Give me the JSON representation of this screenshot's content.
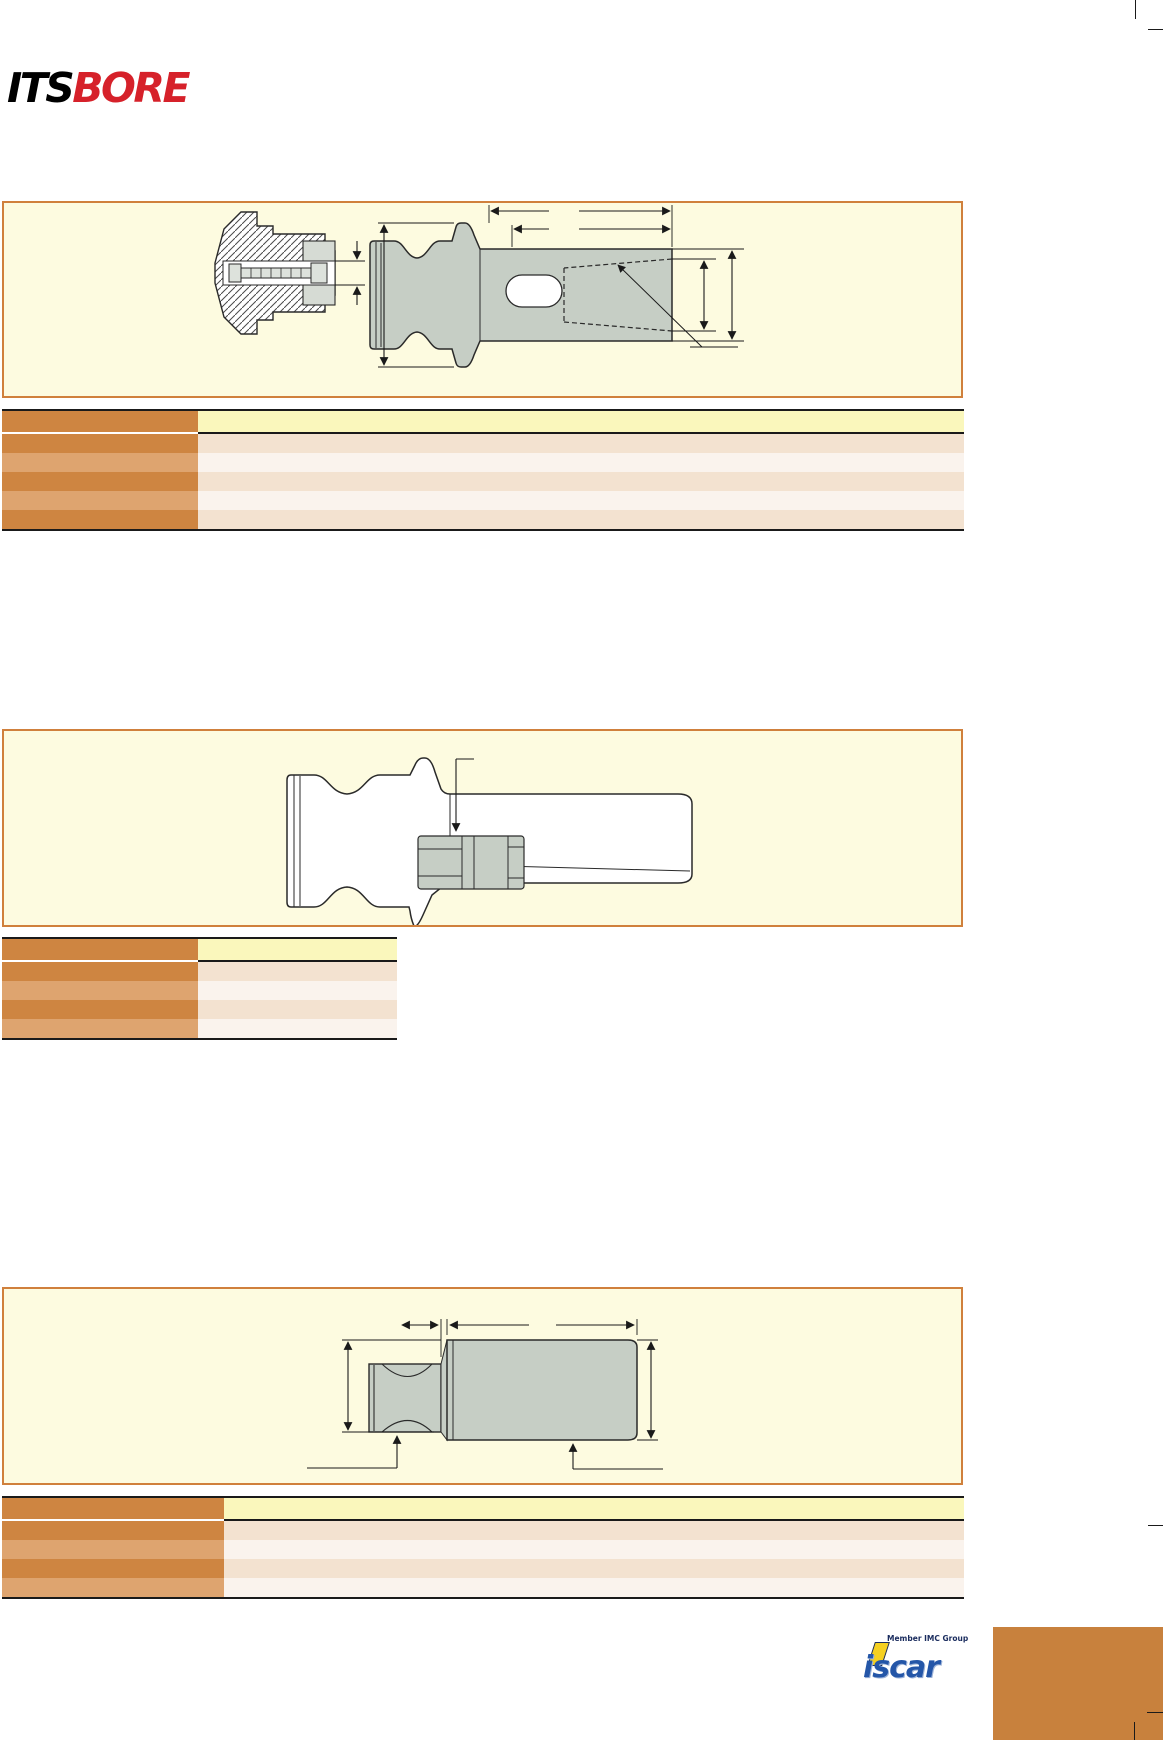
{
  "brand": {
    "its": "ITS",
    "bore": "BORE"
  },
  "footer": {
    "member_text": "Member IMC Group",
    "iscar_text": "iscar"
  },
  "colors": {
    "accent_orange": "#CE8541",
    "accent_orange_light": "#DEA46F",
    "header_yellow": "#FAF7BC",
    "row_tan": "#F3E2D0",
    "row_blush": "#FAF3ED",
    "panel_cream": "#FDFBE0",
    "panel_border": "#D0803C",
    "drawing_fill": "#C6CEC5",
    "logo_red": "#D6212A",
    "iscar_blue": "#2456A8",
    "iscar_yellow": "#F5D020",
    "corner_block_orange": "#C8813D"
  },
  "tables": {
    "table1": {
      "data_rows": 5,
      "columns": 2
    },
    "table2": {
      "data_rows": 4,
      "columns": 2
    },
    "table3": {
      "data_rows": 4,
      "columns": 2
    }
  }
}
